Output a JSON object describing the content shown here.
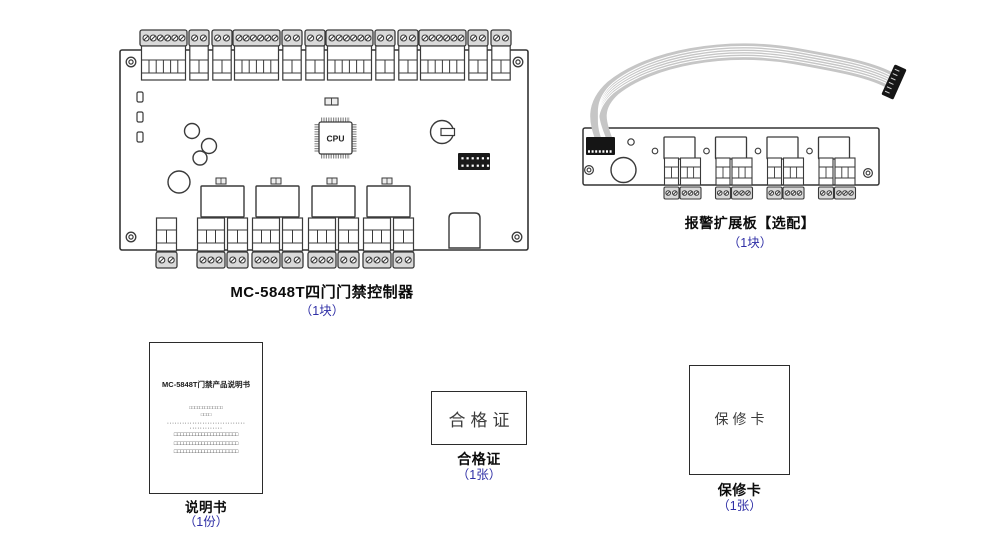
{
  "colors": {
    "accent_blue": "#2f2fa6",
    "line_dark": "#3a3a3a",
    "terminal_cap_gray": "#d9d9d9",
    "cable_gray": "#c9c9c9"
  },
  "controller": {
    "caption": "MC-5848T四门门禁控制器",
    "qty": "（1块）",
    "cpu_label": "CPU"
  },
  "expansion": {
    "caption": "报警扩展板【选配】",
    "qty": "（1块）"
  },
  "manual": {
    "caption": "说明书",
    "qty": "（1份）",
    "cover_title": "MC-5848T门禁产品说明书",
    "cover_lines": [
      "□□□□□□□□□□□□□",
      "□□□□",
      "·······························",
      "·············",
      "□□□□□□□□□□□□□□□□□□□□□",
      "□□□□□□□□□□□□□□□□□□□□□",
      "□□□□□□□□□□□□□□□□□□□□□"
    ]
  },
  "certificate": {
    "caption": "合格证",
    "qty": "（1张）",
    "card_text": "合格证"
  },
  "warranty": {
    "caption": "保修卡",
    "qty": "（1张）",
    "card_text": "保修卡"
  }
}
